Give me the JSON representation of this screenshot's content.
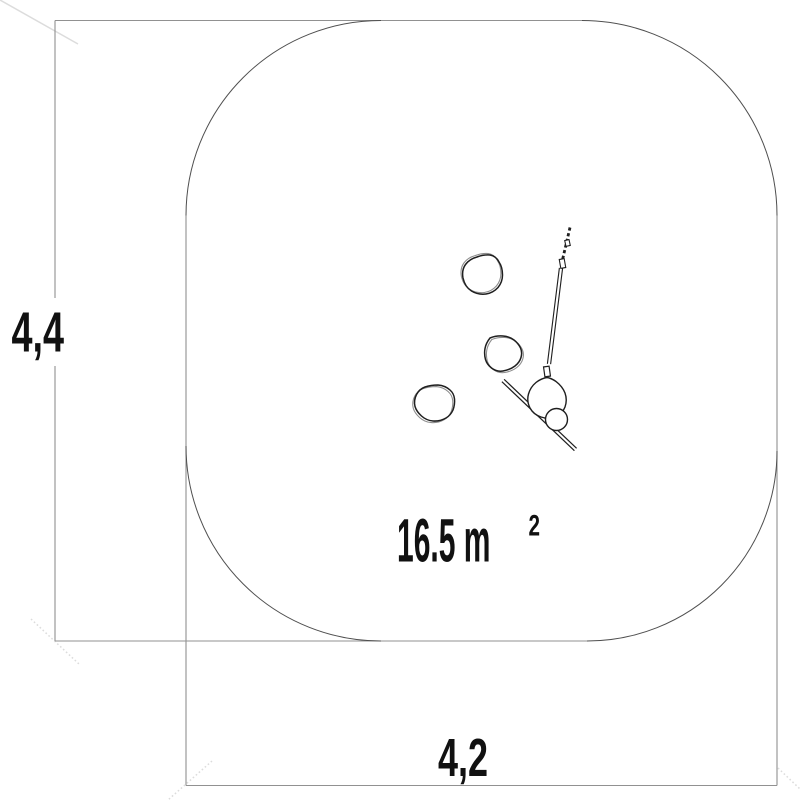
{
  "drawing": {
    "type": "playground-equipment-plan-view",
    "labels": {
      "height_dimension": "4,4",
      "width_dimension": "4,2",
      "area_value": "16.5 m",
      "area_superscript": "2"
    },
    "colors": {
      "background": "#ffffff",
      "frame": "#919191",
      "arc": "#4f4f4f",
      "equipment": "#1f1f1f",
      "text": "#111111",
      "faint": "#dcdcdc"
    }
  }
}
